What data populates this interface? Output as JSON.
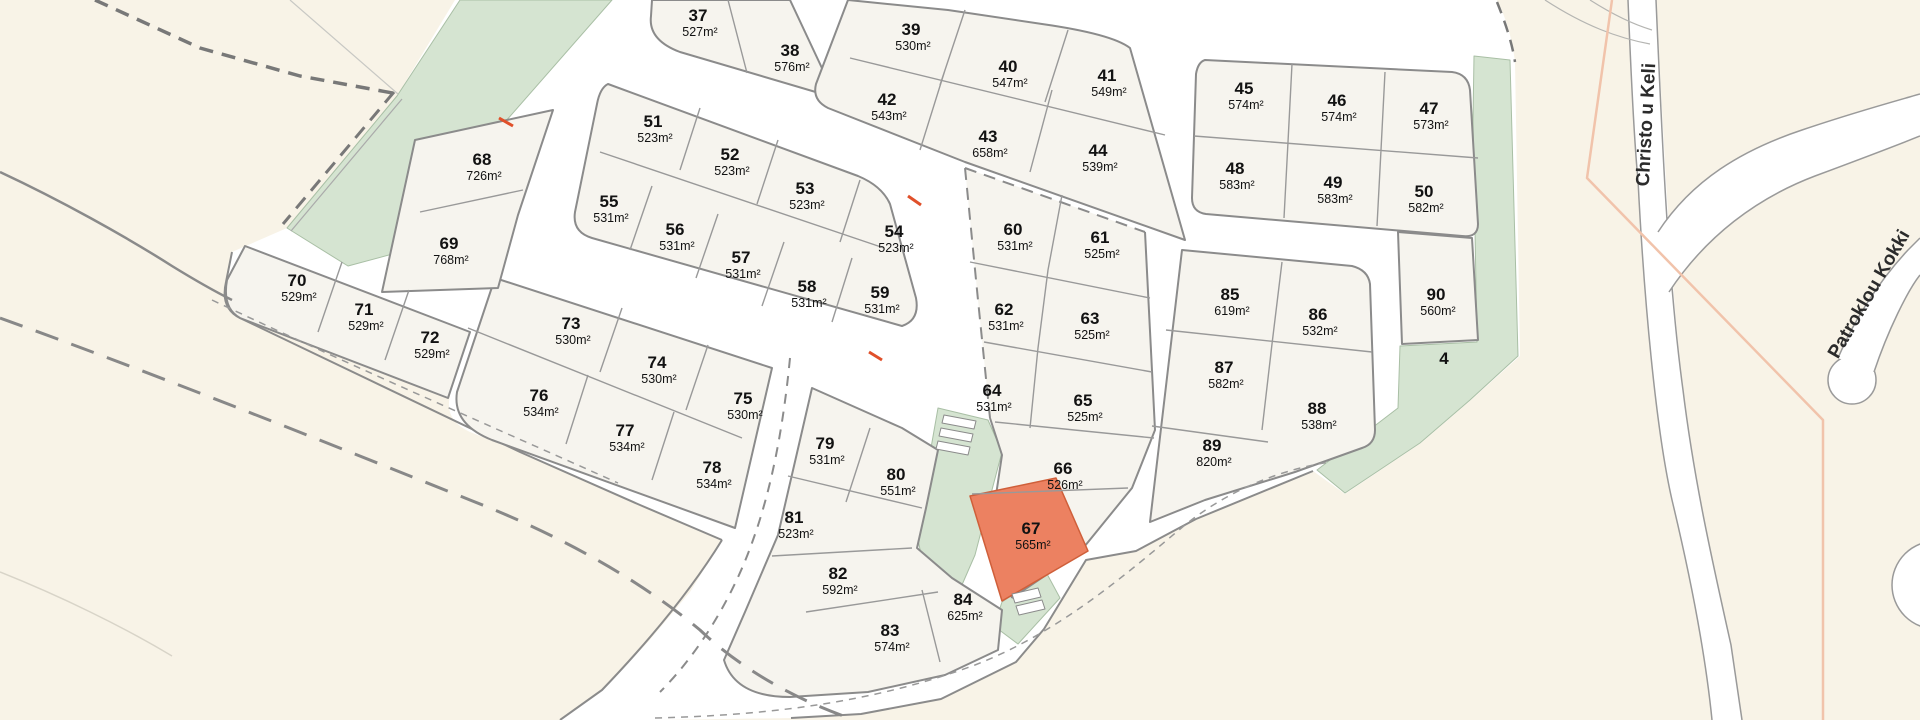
{
  "map": {
    "title": "land-parcel-site-plan",
    "highlighted_plot": "67",
    "colors": {
      "background": "#f8f3e7",
      "subdivision": "#ffffff",
      "block_fill": "#f6f4ee",
      "block_stroke": "#8b8b8b",
      "green_fill": "#d5e4d1",
      "green_stroke": "#a9bfa5",
      "highlight_fill": "#ec8161",
      "highlight_stroke": "#cf5f3a",
      "pink_boundary": "#f1c3ab",
      "red_tick": "#e0502a",
      "road_edge": "#9a9a9a"
    },
    "streets": [
      {
        "name": "Christo u Keli",
        "x": 1652,
        "y": 125,
        "rotate": -87
      },
      {
        "name": "Patroklou Kokki",
        "x": 1874,
        "y": 297,
        "rotate": -60
      }
    ],
    "green_labels": [
      {
        "text": "4",
        "x": 1444,
        "y": 364
      }
    ],
    "plots": [
      {
        "num": "37",
        "area": "527m²",
        "x": 698,
        "y": 15
      },
      {
        "num": "38",
        "area": "576m²",
        "x": 790,
        "y": 50
      },
      {
        "num": "39",
        "area": "530m²",
        "x": 911,
        "y": 29
      },
      {
        "num": "40",
        "area": "547m²",
        "x": 1008,
        "y": 66
      },
      {
        "num": "41",
        "area": "549m²",
        "x": 1107,
        "y": 75
      },
      {
        "num": "42",
        "area": "543m²",
        "x": 887,
        "y": 99
      },
      {
        "num": "43",
        "area": "658m²",
        "x": 988,
        "y": 136
      },
      {
        "num": "44",
        "area": "539m²",
        "x": 1098,
        "y": 150
      },
      {
        "num": "45",
        "area": "574m²",
        "x": 1244,
        "y": 88
      },
      {
        "num": "46",
        "area": "574m²",
        "x": 1337,
        "y": 100
      },
      {
        "num": "47",
        "area": "573m²",
        "x": 1429,
        "y": 108
      },
      {
        "num": "48",
        "area": "583m²",
        "x": 1235,
        "y": 168
      },
      {
        "num": "49",
        "area": "583m²",
        "x": 1333,
        "y": 182
      },
      {
        "num": "50",
        "area": "582m²",
        "x": 1424,
        "y": 191
      },
      {
        "num": "51",
        "area": "523m²",
        "x": 653,
        "y": 121
      },
      {
        "num": "52",
        "area": "523m²",
        "x": 730,
        "y": 154
      },
      {
        "num": "53",
        "area": "523m²",
        "x": 805,
        "y": 188
      },
      {
        "num": "54",
        "area": "523m²",
        "x": 894,
        "y": 231
      },
      {
        "num": "55",
        "area": "531m²",
        "x": 609,
        "y": 201
      },
      {
        "num": "56",
        "area": "531m²",
        "x": 675,
        "y": 229
      },
      {
        "num": "57",
        "area": "531m²",
        "x": 741,
        "y": 257
      },
      {
        "num": "58",
        "area": "531m²",
        "x": 807,
        "y": 286
      },
      {
        "num": "59",
        "area": "531m²",
        "x": 880,
        "y": 292
      },
      {
        "num": "60",
        "area": "531m²",
        "x": 1013,
        "y": 229
      },
      {
        "num": "61",
        "area": "525m²",
        "x": 1100,
        "y": 237
      },
      {
        "num": "62",
        "area": "531m²",
        "x": 1004,
        "y": 309
      },
      {
        "num": "63",
        "area": "525m²",
        "x": 1090,
        "y": 318
      },
      {
        "num": "64",
        "area": "531m²",
        "x": 992,
        "y": 390
      },
      {
        "num": "65",
        "area": "525m²",
        "x": 1083,
        "y": 400
      },
      {
        "num": "66",
        "area": "526m²",
        "x": 1063,
        "y": 468
      },
      {
        "num": "67",
        "area": "565m²",
        "x": 1031,
        "y": 528
      },
      {
        "num": "68",
        "area": "726m²",
        "x": 482,
        "y": 159
      },
      {
        "num": "69",
        "area": "768m²",
        "x": 449,
        "y": 243
      },
      {
        "num": "70",
        "area": "529m²",
        "x": 297,
        "y": 280
      },
      {
        "num": "71",
        "area": "529m²",
        "x": 364,
        "y": 309
      },
      {
        "num": "72",
        "area": "529m²",
        "x": 430,
        "y": 337
      },
      {
        "num": "73",
        "area": "530m²",
        "x": 571,
        "y": 323
      },
      {
        "num": "74",
        "area": "530m²",
        "x": 657,
        "y": 362
      },
      {
        "num": "75",
        "area": "530m²",
        "x": 743,
        "y": 398
      },
      {
        "num": "76",
        "area": "534m²",
        "x": 539,
        "y": 395
      },
      {
        "num": "77",
        "area": "534m²",
        "x": 625,
        "y": 430
      },
      {
        "num": "78",
        "area": "534m²",
        "x": 712,
        "y": 467
      },
      {
        "num": "79",
        "area": "531m²",
        "x": 825,
        "y": 443
      },
      {
        "num": "80",
        "area": "551m²",
        "x": 896,
        "y": 474
      },
      {
        "num": "81",
        "area": "523m²",
        "x": 794,
        "y": 517
      },
      {
        "num": "82",
        "area": "592m²",
        "x": 838,
        "y": 573
      },
      {
        "num": "83",
        "area": "574m²",
        "x": 890,
        "y": 630
      },
      {
        "num": "84",
        "area": "625m²",
        "x": 963,
        "y": 599
      },
      {
        "num": "85",
        "area": "619m²",
        "x": 1230,
        "y": 294
      },
      {
        "num": "86",
        "area": "532m²",
        "x": 1318,
        "y": 314
      },
      {
        "num": "87",
        "area": "582m²",
        "x": 1224,
        "y": 367
      },
      {
        "num": "88",
        "area": "538m²",
        "x": 1317,
        "y": 408
      },
      {
        "num": "89",
        "area": "820m²",
        "x": 1212,
        "y": 445
      },
      {
        "num": "90",
        "area": "560m²",
        "x": 1436,
        "y": 294
      }
    ],
    "shapes": [
      {
        "n": "background",
        "i": "false",
        "d": "M0,0H1920V720H0Z",
        "f": "#f8f3e7"
      },
      {
        "n": "subdivision-area",
        "i": "false",
        "d": "M455,0 L1497,0 Q1511,28 1515,62 L1520,356 L1471,400 L1421,443 L1345,494 L1313,471 L1196,519 L1136,551 L1086,560 L1044,629 L1016,662 L941,699 L861,714 L791,718 L660,720 L560,720 L602,690 L648,642 L690,592 L722,540 L640,505 L520,452 L470,432 Q444,420 450,396 L436,390 L240,318 Q220,308 226,282 L232,252 L287,228 L397,96 Z",
        "f": "#ffffff"
      },
      {
        "n": "outer-road-edge-sw",
        "i": "false",
        "d": "M232,252 L226,282 Q220,308 240,318 L520,452 L640,505 L722,540",
        "s": "#8b8b8b",
        "w": 2
      },
      {
        "n": "outer-road-edge-s",
        "i": "false",
        "d": "M722,540 C690,592 648,642 602,690 L560,720",
        "s": "#8b8b8b",
        "w": 2
      },
      {
        "n": "outer-road-edge-se",
        "i": "false",
        "d": "M791,718 L861,714 L941,699 L1016,662 L1044,629 L1086,560 L1136,551 L1196,519 L1313,471",
        "s": "#8b8b8b",
        "w": 2
      },
      {
        "n": "green-area-wedge",
        "i": "false",
        "d": "M460,0 L612,0 L505,122 L478,168 L445,210 L400,252 L348,266 L287,228 L397,96 Z",
        "f": "#d5e4d1",
        "s": "#a9bfa5",
        "w": 1
      },
      {
        "n": "green-area-east",
        "i": "false",
        "d": "M1474,56 L1510,60 L1518,356 L1470,400 L1420,443 L1345,493 L1317,470 L1398,408 L1400,346 L1477,342 L1473,120 Z",
        "f": "#d5e4d1",
        "s": "#a9bfa5",
        "w": 1
      },
      {
        "n": "green-strip-middle",
        "i": "false",
        "d": "M938,408 L988,420 L1002,452 L988,505 L975,555 L958,594 L928,586 L918,540 L928,465 Z",
        "f": "#d5e4d1",
        "s": "#a9bfa5",
        "w": 1
      },
      {
        "n": "green-patch-south",
        "i": "false",
        "d": "M1002,602 L1046,572 L1060,598 L1018,644 L994,626 Z",
        "f": "#d5e4d1",
        "s": "#a9bfa5",
        "w": 1
      },
      {
        "n": "block-37-38",
        "i": "false",
        "d": "M790,0 L836,98 L680,52 Q648,40 651,16 L652,0 Z",
        "f": "#f6f4ee",
        "s": "#8b8b8b",
        "w": 2
      },
      {
        "n": "block-39-44",
        "i": "false",
        "d": "M848,0 L948,10 L1042,24 Q1112,34 1130,48 L1185,240 L965,162 L828,108 Q812,100 816,84 Z",
        "f": "#f6f4ee",
        "s": "#8b8b8b",
        "w": 2
      },
      {
        "n": "block-51-59",
        "i": "false",
        "d": "M608,84 L858,176 Q882,186 890,204 L916,298 Q920,320 902,326 L592,238 Q572,232 575,212 L597,104 Q600,88 608,84 Z",
        "f": "#f6f4ee",
        "s": "#8b8b8b",
        "w": 2
      },
      {
        "n": "block-73-78",
        "i": "false",
        "d": "M495,278 L772,368 L735,528 L492,440 Q452,424 457,392 Z",
        "f": "#f6f4ee",
        "s": "#8b8b8b",
        "w": 2
      },
      {
        "n": "block-70-72",
        "i": "false",
        "d": "M245,246 L470,332 L448,398 L240,318 Q222,308 227,280 Z",
        "f": "#f6f4ee",
        "s": "#8b8b8b",
        "w": 2
      },
      {
        "n": "block-68-69",
        "i": "false",
        "d": "M415,140 L553,110 L518,215 L498,288 L382,292 Z",
        "f": "#f6f4ee",
        "s": "#8b8b8b",
        "w": 2
      },
      {
        "n": "block-79-84",
        "i": "false",
        "d": "M812,388 L902,428 L938,450 L926,508 L917,548 L952,578 L1002,610 L998,650 L945,675 L868,692 L790,697 Q735,697 724,660 L745,612 L778,535 L800,440 Z",
        "f": "#f6f4ee",
        "s": "#8b8b8b",
        "w": 2
      },
      {
        "n": "block-60-67-fill",
        "i": "false",
        "d": "M965,168 L1145,232 L1155,430 L1132,488 L1080,552 L1012,598 L992,522 L1002,455 L990,418 L978,300 Z",
        "f": "#f6f4ee"
      },
      {
        "n": "block-60-67-solid-edges",
        "i": "false",
        "d": "M1145,232 L1155,430 L1132,488 L1080,552 L1012,598 M990,418 L1002,455 L992,522 L1012,598",
        "s": "#8b8b8b",
        "w": 2
      },
      {
        "n": "block-60-67-dashed-edges",
        "i": "false",
        "d": "M965,168 L1145,232 M965,168 L978,300 L990,418",
        "s": "#8b8b8b",
        "w": 2,
        "da": "12 8"
      },
      {
        "n": "block-85-89",
        "i": "false",
        "d": "M1182,250 L1352,266 Q1368,270 1370,284 L1375,430 Q1375,444 1362,448 L1295,472 L1205,500 L1150,522 Z",
        "f": "#f6f4ee",
        "s": "#8b8b8b",
        "w": 2
      },
      {
        "n": "block-45-50",
        "i": "false",
        "d": "M1205,60 L1452,72 Q1468,74 1470,90 L1478,224 Q1478,238 1462,236 L1206,214 Q1192,212 1192,198 L1196,74 Q1198,62 1205,60 Z",
        "f": "#f6f4ee",
        "s": "#8b8b8b",
        "w": 2
      },
      {
        "n": "block-90",
        "i": "false",
        "d": "M1398,232 L1472,238 L1478,340 L1402,344 Z",
        "f": "#f6f4ee",
        "s": "#8b8b8b",
        "w": 2
      },
      {
        "n": "parcel-67-highlight",
        "i": "true",
        "d": "M970,496 L1056,478 L1088,551 L1002,601 Z",
        "f": "#ec8161",
        "s": "#cf5f3a",
        "w": 1.5
      },
      {
        "n": "hatch-structure-bar",
        "i": "false",
        "d": "M944,415 L976,421 L974,429 L942,423 Z",
        "f": "#ffffff",
        "s": "#8b8b8b",
        "w": 1
      },
      {
        "n": "hatch-structure-bar",
        "i": "false",
        "d": "M941,428 L973,434 L971,442 L939,436 Z",
        "f": "#ffffff",
        "s": "#8b8b8b",
        "w": 1
      },
      {
        "n": "hatch-structure-bar",
        "i": "false",
        "d": "M938,441 L970,447 L968,455 L936,449 Z",
        "f": "#ffffff",
        "s": "#8b8b8b",
        "w": 1
      },
      {
        "n": "hatch-structure-bar",
        "i": "false",
        "d": "M1012,594 L1038,588 L1041,597 L1015,603 Z",
        "f": "#ffffff",
        "s": "#8b8b8b",
        "w": 1
      },
      {
        "n": "hatch-structure-bar",
        "i": "false",
        "d": "M1016,606 L1042,600 L1045,609 L1019,615 Z",
        "f": "#ffffff",
        "s": "#8b8b8b",
        "w": 1
      },
      {
        "n": "parcel-divider-lines",
        "i": "false",
        "d": "M728,0 L747,73 M850,58 L1165,135 M965,10 L940,85 M1068,30 L1045,102 M945,70 L920,150 M1052,90 L1030,172 M600,152 L884,248 M700,108 L680,170 M778,140 L757,204 M860,180 L840,242 M652,186 L630,250 M718,214 L696,278 M784,242 L762,306 M852,258 L832,322 M468,328 L742,438 M622,308 L600,372 M708,345 L686,410 M588,375 L566,444 M674,412 L652,480 M342,262 L318,332 M409,290 L385,360 M420,212 L523,190 M870,428 L846,502 M788,476 L922,508 M772,556 L912,548 M806,612 L938,592 M922,590 L940,662 M970,262 L1150,298 M984,342 L1152,372 M995,422 L1154,438 M1062,195 L1048,270 M1048,270 L1038,348 M1038,348 L1030,428 M972,494 L1128,488 M1166,330 L1372,352 M1282,262 L1272,344 M1272,344 L1262,430 M1152,426 L1268,442 M1194,136 L1478,158 M1292,64 L1288,142 M1385,72 L1381,150 M1288,142 L1284,218 M1381,150 L1377,226",
        "s": "#999999",
        "w": 1.4
      },
      {
        "n": "boundary-dashed-topleft",
        "i": "false",
        "d": "M95,0 L200,48 L300,76 L398,94",
        "s": "#787878",
        "w": 3.5,
        "da": "14 9"
      },
      {
        "n": "boundary-dashed-greenedge",
        "i": "false",
        "d": "M394,92 L283,224",
        "s": "#787878",
        "w": 3,
        "da": "14 9"
      },
      {
        "n": "boundary-thin-greenedge",
        "i": "false",
        "d": "M402,99 L291,231",
        "s": "#aaaaaa",
        "w": 1.2
      },
      {
        "n": "boundary-longdash-sw",
        "i": "false",
        "d": "M0,318 C150,372 320,440 470,500 C560,535 640,580 700,630 C740,668 795,700 855,720",
        "s": "#888888",
        "w": 3,
        "da": "24 14"
      },
      {
        "n": "boundary-dashed-ne",
        "i": "false",
        "d": "M1497,2 C1505,22 1512,42 1515,62",
        "s": "#787878",
        "w": 2.5,
        "da": "12 8"
      },
      {
        "n": "boundary-thindash-sw",
        "i": "false",
        "d": "M212,300 C360,370 500,430 618,483",
        "s": "#999999",
        "w": 1.5,
        "da": "7 6"
      },
      {
        "n": "boundary-thindash-se",
        "i": "false",
        "d": "M655,718 C780,715 880,700 975,665 C1060,632 1125,575 1185,525 C1235,485 1290,468 1330,462",
        "s": "#999999",
        "w": 1.5,
        "da": "7 6"
      },
      {
        "n": "road-center-dashed",
        "i": "false",
        "d": "M790,358 C783,430 771,490 753,540 C735,592 702,650 660,692",
        "s": "#8b8b8b",
        "w": 2,
        "da": "10 8"
      },
      {
        "n": "terrain-line-west",
        "i": "false",
        "d": "M0,172 C60,200 125,236 172,266 C198,282 216,292 232,300",
        "s": "#8a8a8a",
        "w": 2.5
      },
      {
        "n": "terrain-line-topleft",
        "i": "false",
        "d": "M290,0 L398,94",
        "s": "#c8c8c4",
        "w": 1.2
      },
      {
        "n": "terrain-line-bottomleft",
        "i": "false",
        "d": "M0,572 C60,596 122,626 172,656",
        "s": "#d8d4c8",
        "w": 1.5
      },
      {
        "n": "road-christo-fill",
        "i": "false",
        "d": "M1628,0 L1656,0 C1664,140 1670,280 1683,390 C1694,480 1712,560 1731,645 L1742,720 L1712,720 C1705,650 1690,575 1672,500 C1656,430 1644,300 1638,180 C1634,120 1630,60 1628,0 Z",
        "f": "#ffffff"
      },
      {
        "n": "road-christo-edge-w",
        "i": "false",
        "d": "M1628,0 C1632,100 1635,150 1638,180 C1644,300 1656,430 1672,500 C1690,575 1705,650 1712,720",
        "s": "#9a9a9a",
        "w": 1.5
      },
      {
        "n": "road-christo-edge-e",
        "i": "false",
        "d": "M1656,0 C1662,140 1668,280 1683,390 C1694,480 1712,560 1731,645 L1742,720",
        "s": "#9a9a9a",
        "w": 1.5
      },
      {
        "n": "road-branch-fill",
        "i": "false",
        "d": "M1658,232 C1692,180 1742,150 1802,130 C1852,113 1892,102 1920,94 L1920,136 C1895,146 1858,160 1815,176 C1757,198 1706,236 1669,292 Z",
        "f": "#ffffff"
      },
      {
        "n": "road-branch-edge-n",
        "i": "false",
        "d": "M1658,232 C1692,180 1742,150 1802,130 C1852,113 1892,102 1920,94",
        "s": "#9a9a9a",
        "w": 1.5
      },
      {
        "n": "road-branch-edge-s",
        "i": "false",
        "d": "M1669,292 C1706,236 1757,198 1815,176 C1858,160 1895,146 1920,136",
        "s": "#9a9a9a",
        "w": 1.5
      },
      {
        "n": "road-stub-edge",
        "i": "false",
        "d": "M1545,0 C1585,26 1618,38 1650,44",
        "s": "#b5b5b2",
        "w": 1.2
      },
      {
        "n": "road-stub-edge",
        "i": "false",
        "d": "M1590,0 C1612,14 1632,24 1652,30",
        "s": "#b5b5b2",
        "w": 1.2
      },
      {
        "n": "road-patroklou-bulb",
        "i": "false",
        "d": "M1828,380 a24,24 0 1,0 48,0 a24,24 0 1,0 -48,0",
        "f": "#ffffff",
        "s": "#9a9a9a",
        "w": 1.5
      },
      {
        "n": "road-patroklou-fill",
        "i": "false",
        "d": "M1838,358 C1855,318 1880,280 1908,250 L1920,238 L1920,275 C1908,290 1888,330 1874,372 Z",
        "f": "#ffffff"
      },
      {
        "n": "road-patroklou-edge-w",
        "i": "false",
        "d": "M1838,358 C1855,318 1880,280 1908,250 L1920,238",
        "s": "#9a9a9a",
        "w": 1.5
      },
      {
        "n": "road-patroklou-edge-e",
        "i": "false",
        "d": "M1874,372 C1888,330 1908,290 1920,275",
        "s": "#9a9a9a",
        "w": 1.5
      },
      {
        "n": "road-partial-bottomright",
        "i": "false",
        "d": "M1892,585 a44,44 0 1,0 88,0 a44,44 0 1,0 -88,0",
        "f": "#ffffff",
        "s": "#9a9a9a",
        "w": 1.5
      },
      {
        "n": "pink-boundary-line",
        "i": "false",
        "d": "M1612,0 L1587,178 L1823,420 L1823,720",
        "s": "#f1c3ab",
        "w": 2.5
      },
      {
        "n": "red-survey-tick",
        "i": "false",
        "d": "M499,118 L513,126",
        "s": "#e0502a",
        "w": 3
      },
      {
        "n": "red-survey-tick",
        "i": "false",
        "d": "M908,196 L921,205",
        "s": "#e0502a",
        "w": 3
      },
      {
        "n": "red-survey-tick",
        "i": "false",
        "d": "M869,352 L882,360",
        "s": "#e0502a",
        "w": 3
      }
    ]
  }
}
